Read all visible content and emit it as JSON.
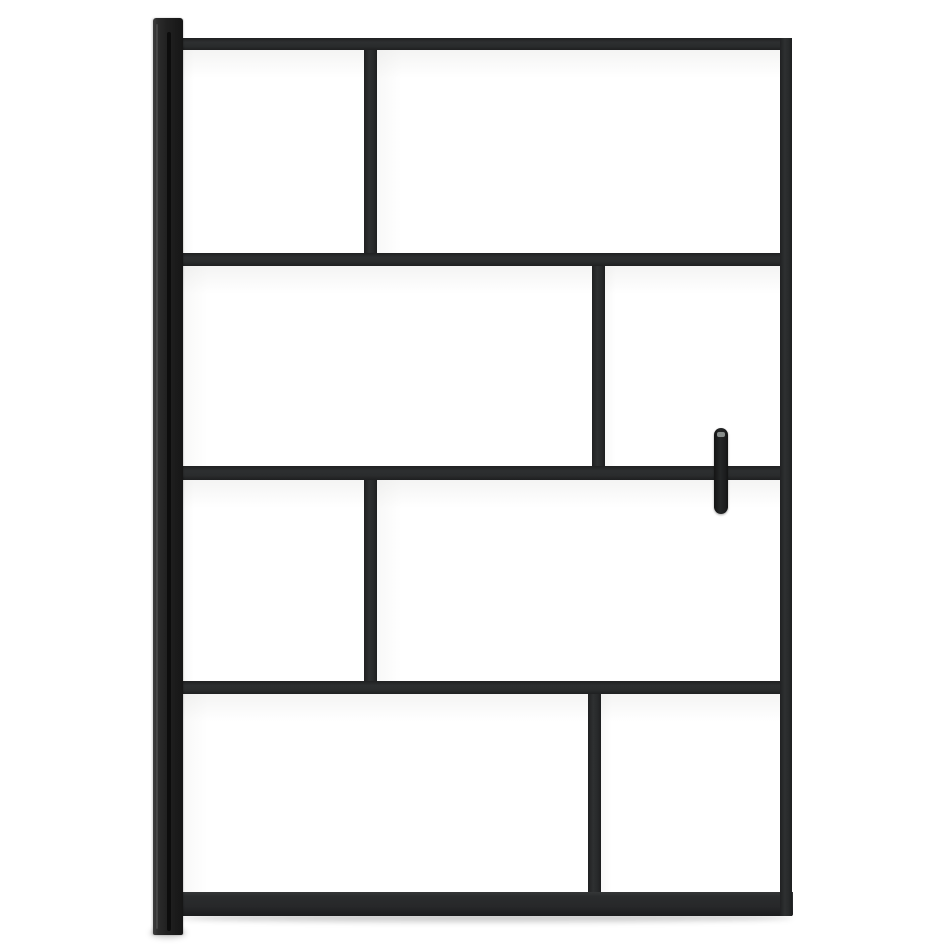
{
  "scene": {
    "description": "Product photo on a white background: black-framed walk-in shower screen with eight clear glass panels arranged in an offset brick pattern, a wall-mounting profile on the left side and a vertical capsule door handle on the right.",
    "object": "walk-in shower screen with black frame",
    "panel_count": 8,
    "row_count": 4,
    "colors": {
      "background": "#ffffff",
      "frame": "#2a2c2d",
      "frame_dark_edge": "#1b1c1d",
      "wall_profile": "#212121",
      "wall_profile_groove": "#0c0c0c",
      "glass": "#ffffff",
      "handle": "#1c1d1e",
      "handle_highlight": "#9aa09e",
      "shadow": "rgba(0,0,0,0.20)"
    },
    "parts": {
      "wall_profile": "wall mounting profile",
      "top_rail": "top rail",
      "middle_rail_1": "middle rail 1",
      "middle_rail_2": "middle rail 2",
      "middle_rail_3": "middle rail 3",
      "bottom_rail": "bottom rail",
      "right_stile": "right stile",
      "mullion_row1": "row 1 mullion",
      "mullion_row2": "row 2 mullion",
      "mullion_row3": "row 3 mullion",
      "mullion_row4": "row 4 mullion",
      "handle": "door handle",
      "glass_panels": [
        "row 1 left glass panel",
        "row 1 right glass panel",
        "row 2 left glass panel",
        "row 2 right glass panel",
        "row 3 left glass panel",
        "row 3 right glass panel",
        "row 4 left glass panel",
        "row 4 right glass panel"
      ]
    }
  }
}
